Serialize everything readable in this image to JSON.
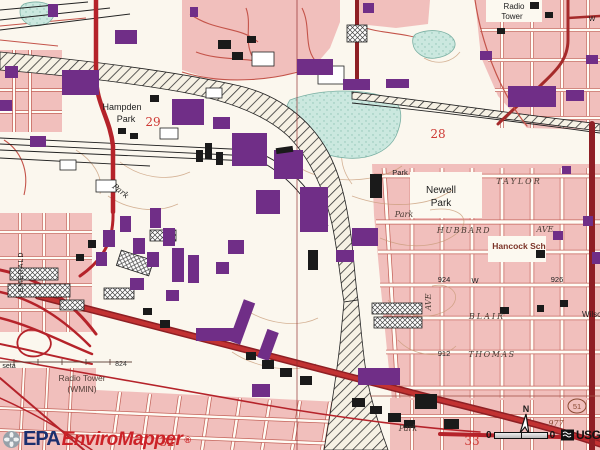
{
  "map": {
    "colors": {
      "residential_pink": "#F1BFBC",
      "building_purple": "#702E87",
      "building_black": "#1A1A1A",
      "road_red": "#C23232",
      "road_dark_red": "#8E1F24",
      "water_cyan": "#CBE8DF",
      "contour_brown": "#C79A76",
      "epa_blue": "#1B2F6E",
      "enviromapper_red": "#CC2227"
    },
    "attribution": {
      "epa": "EPA",
      "enviromapper": "EnviroMapper",
      "registered": "®",
      "usgs": "USGS"
    },
    "scale_bar": {
      "left_label": "0",
      "right_label": "0"
    },
    "labels": [
      {
        "text": "Radio",
        "x": 514,
        "y": 9,
        "s": 8
      },
      {
        "text": "Tower",
        "x": 512,
        "y": 19,
        "s": 8
      },
      {
        "text": "Hampden",
        "x": 122,
        "y": 110,
        "s": 9
      },
      {
        "text": "Park",
        "x": 126,
        "y": 122,
        "s": 9
      },
      {
        "text": "29",
        "x": 153,
        "y": 126,
        "s": 12,
        "c": "#CE3A35",
        "serif": 1,
        "name": "section-number-29"
      },
      {
        "text": "Park",
        "x": 119,
        "y": 193,
        "s": 8,
        "i": 1,
        "serif": 1,
        "r": 38
      },
      {
        "text": "Park",
        "x": 400,
        "y": 175,
        "s": 7.5
      },
      {
        "text": "Newell",
        "x": 441,
        "y": 193,
        "s": 10
      },
      {
        "text": "Park",
        "x": 441,
        "y": 206,
        "s": 10
      },
      {
        "text": "TAYLOR",
        "x": 519,
        "y": 184,
        "s": 8,
        "i": 1,
        "serif": 1,
        "ls": 2,
        "c": "#4A3B33"
      },
      {
        "text": "Park",
        "x": 404,
        "y": 217,
        "s": 8,
        "i": 1,
        "serif": 1,
        "c": "#4A3B33"
      },
      {
        "text": "HUBBARD",
        "x": 464,
        "y": 233,
        "s": 8,
        "i": 1,
        "serif": 1,
        "ls": 1.5,
        "c": "#4A3B33"
      },
      {
        "text": "AVE",
        "x": 545,
        "y": 232,
        "s": 8,
        "i": 1,
        "serif": 1,
        "c": "#4A3B33"
      },
      {
        "text": "Hancock Sch",
        "x": 519,
        "y": 249,
        "s": 8.5,
        "c": "#7B3327",
        "b": 1
      },
      {
        "text": "924",
        "x": 444,
        "y": 282,
        "s": 7.5
      },
      {
        "text": "W",
        "x": 475,
        "y": 283,
        "s": 7.5
      },
      {
        "text": "926",
        "x": 557,
        "y": 282,
        "s": 7.5
      },
      {
        "text": "AVE",
        "x": 431,
        "y": 302,
        "s": 8,
        "i": 1,
        "serif": 1,
        "r": -90,
        "c": "#4A3B33"
      },
      {
        "text": "BLAIR",
        "x": 487,
        "y": 319,
        "s": 8,
        "i": 1,
        "serif": 1,
        "ls": 2,
        "c": "#4A3B33"
      },
      {
        "text": "912",
        "x": 444,
        "y": 356,
        "s": 7.5
      },
      {
        "text": "THOMAS",
        "x": 492,
        "y": 357,
        "s": 8,
        "i": 1,
        "serif": 1,
        "ls": 1.5,
        "c": "#4A3B33"
      },
      {
        "text": "Wilson",
        "x": 594,
        "y": 317,
        "s": 8
      },
      {
        "text": "W",
        "x": 592,
        "y": 21,
        "s": 7
      },
      {
        "text": "28",
        "x": 438,
        "y": 138,
        "s": 12,
        "c": "#CE3A35",
        "serif": 1,
        "name": "section-number-28"
      },
      {
        "text": "32",
        "x": 167,
        "y": 446,
        "s": 12,
        "c": "#CE3A35",
        "serif": 1,
        "name": "section-number-32"
      },
      {
        "text": "33",
        "x": 472,
        "y": 445,
        "s": 12,
        "c": "#CE3A35",
        "serif": 1,
        "name": "section-number-33"
      },
      {
        "text": "Radio Tower",
        "x": 82,
        "y": 381,
        "s": 8.5,
        "c": "#54403A"
      },
      {
        "text": "(WMIN)",
        "x": 82,
        "y": 392,
        "s": 8.5,
        "c": "#54403A"
      },
      {
        "text": "824",
        "x": 121,
        "y": 366,
        "s": 7,
        "c": "#3A3A3A"
      },
      {
        "text": "977",
        "x": 556,
        "y": 426,
        "s": 8,
        "i": 1,
        "serif": 1,
        "c": "#8A4A33"
      },
      {
        "text": "51",
        "x": 577,
        "y": 409,
        "s": 7.5,
        "c": "#8A4A33",
        "name": "route-51-label"
      },
      {
        "text": "seta",
        "x": 9,
        "y": 368,
        "s": 7
      },
      {
        "text": "EMERALD",
        "x": 23,
        "y": 272,
        "s": 7,
        "ls": 1,
        "r": -90
      },
      {
        "text": "Park",
        "x": 408,
        "y": 431,
        "s": 8,
        "i": 1,
        "serif": 1,
        "c": "#4A3B33"
      },
      {
        "text": "N",
        "x": 526,
        "y": 412,
        "s": 9,
        "b": 1,
        "name": "north-arrow-label"
      }
    ]
  }
}
